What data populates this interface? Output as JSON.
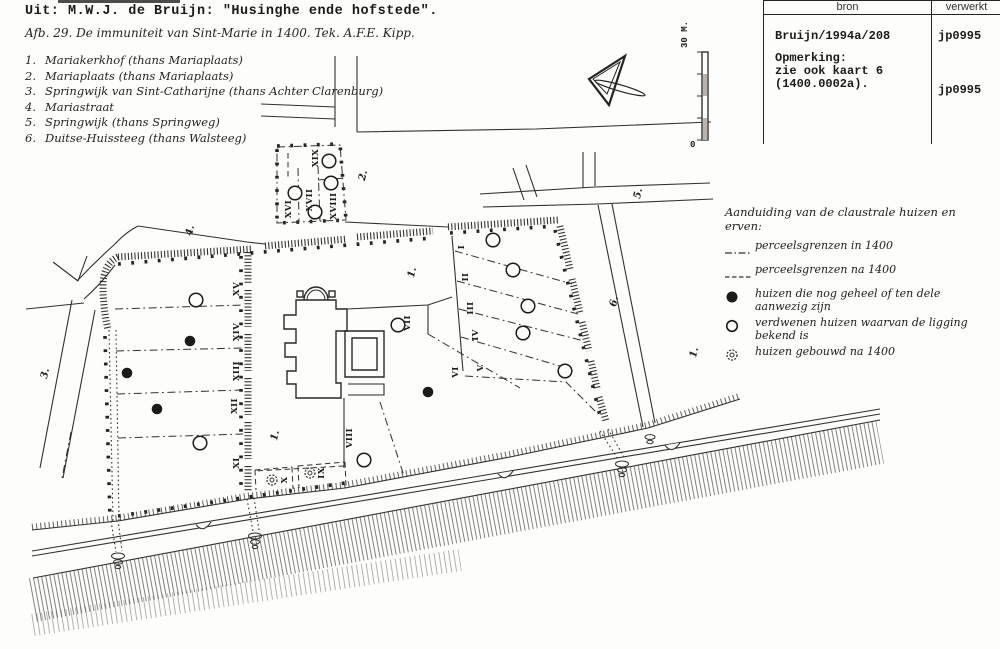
{
  "header": {
    "source_line": "Uit: M.W.J. de Bruijn: \"Husinghe ende hofstede\".",
    "caption": "Afb. 29. De immuniteit van Sint-Marie in 1400. Tek. A.F.E. Kipp."
  },
  "street_list": [
    {
      "num": "1.",
      "label": "Mariakerkhof (thans Mariaplaats)"
    },
    {
      "num": "2.",
      "label": "Mariaplaats (thans Mariaplaats)"
    },
    {
      "num": "3.",
      "label": "Springwijk van Sint-Catharijne (thans Achter Clarenburg)"
    },
    {
      "num": "4.",
      "label": "Mariastraat"
    },
    {
      "num": "5.",
      "label": "Springwijk (thans Springweg)"
    },
    {
      "num": "6.",
      "label": "Duitse-Huissteeg (thans Walsteeg)"
    }
  ],
  "catalog_table": {
    "col_bron": "bron",
    "col_verwerkt": "verwerkt",
    "bron_entry": "Bruijn/1994a/208",
    "verwerkt_entry1": "jp0995",
    "remark_label": "Opmerking:",
    "remark_line2": "zie ook kaart 6",
    "remark_line3": "(1400.0002a).",
    "verwerkt_entry2": "jp0995"
  },
  "legend": {
    "title": "Aanduiding van de claustrale huizen en erven:",
    "items": [
      {
        "symbol": "dashdot-line",
        "text": "perceelsgrenzen in 1400"
      },
      {
        "symbol": "dashed-line",
        "text": "perceelsgrenzen na 1400"
      },
      {
        "symbol": "filled-circle",
        "text": "huizen die nog geheel of ten dele aanwezig zijn"
      },
      {
        "symbol": "open-circle",
        "text": "verdwenen huizen waarvan de ligging bekend is"
      },
      {
        "symbol": "hatched-circle",
        "text": "huizen gebouwd na 1400"
      }
    ]
  },
  "map": {
    "scale_bar": {
      "top_label": "30 M.",
      "bottom_label": "0"
    },
    "street_labels": [
      {
        "text": "1.",
        "x": 415,
        "y": 273
      },
      {
        "text": "1.",
        "x": 278,
        "y": 436
      },
      {
        "text": "1.",
        "x": 697,
        "y": 353
      },
      {
        "text": "2.",
        "x": 366,
        "y": 176
      },
      {
        "text": "3.",
        "x": 48,
        "y": 374
      },
      {
        "text": "4.",
        "x": 193,
        "y": 231
      },
      {
        "text": "5.",
        "x": 641,
        "y": 194
      },
      {
        "text": "6.",
        "x": 617,
        "y": 302
      }
    ],
    "parcel_labels": [
      {
        "text": "I",
        "x": 464,
        "y": 247
      },
      {
        "text": "II",
        "x": 468,
        "y": 277
      },
      {
        "text": "III",
        "x": 473,
        "y": 308
      },
      {
        "text": "IV",
        "x": 478,
        "y": 335
      },
      {
        "text": "V",
        "x": 483,
        "y": 368
      },
      {
        "text": "VI",
        "x": 458,
        "y": 372
      },
      {
        "text": "VII",
        "x": 410,
        "y": 323
      },
      {
        "text": "VIII",
        "x": 352,
        "y": 438
      },
      {
        "text": "IX",
        "x": 324,
        "y": 473
      },
      {
        "text": "X",
        "x": 287,
        "y": 480
      },
      {
        "text": "XI",
        "x": 239,
        "y": 463
      },
      {
        "text": "XII",
        "x": 237,
        "y": 406
      },
      {
        "text": "XIII",
        "x": 239,
        "y": 371
      },
      {
        "text": "XIV",
        "x": 239,
        "y": 332
      },
      {
        "text": "XV",
        "x": 239,
        "y": 289
      },
      {
        "text": "XVI",
        "x": 291,
        "y": 209
      },
      {
        "text": "XVII",
        "x": 312,
        "y": 200
      },
      {
        "text": "XVIII",
        "x": 336,
        "y": 206
      },
      {
        "text": "XIX",
        "x": 318,
        "y": 158
      }
    ],
    "markers": {
      "filled": [
        [
          190,
          341
        ],
        [
          127,
          373
        ],
        [
          157,
          409
        ],
        [
          428,
          392
        ]
      ],
      "open": [
        [
          196,
          300
        ],
        [
          200,
          443
        ],
        [
          295,
          193
        ],
        [
          315,
          212
        ],
        [
          331,
          183
        ],
        [
          329,
          161
        ],
        [
          398,
          325
        ],
        [
          493,
          240
        ],
        [
          513,
          270
        ],
        [
          528,
          306
        ],
        [
          523,
          333
        ],
        [
          565,
          371
        ],
        [
          364,
          460
        ]
      ],
      "built_after_1400": [
        [
          272,
          480
        ],
        [
          310,
          473
        ]
      ]
    }
  }
}
